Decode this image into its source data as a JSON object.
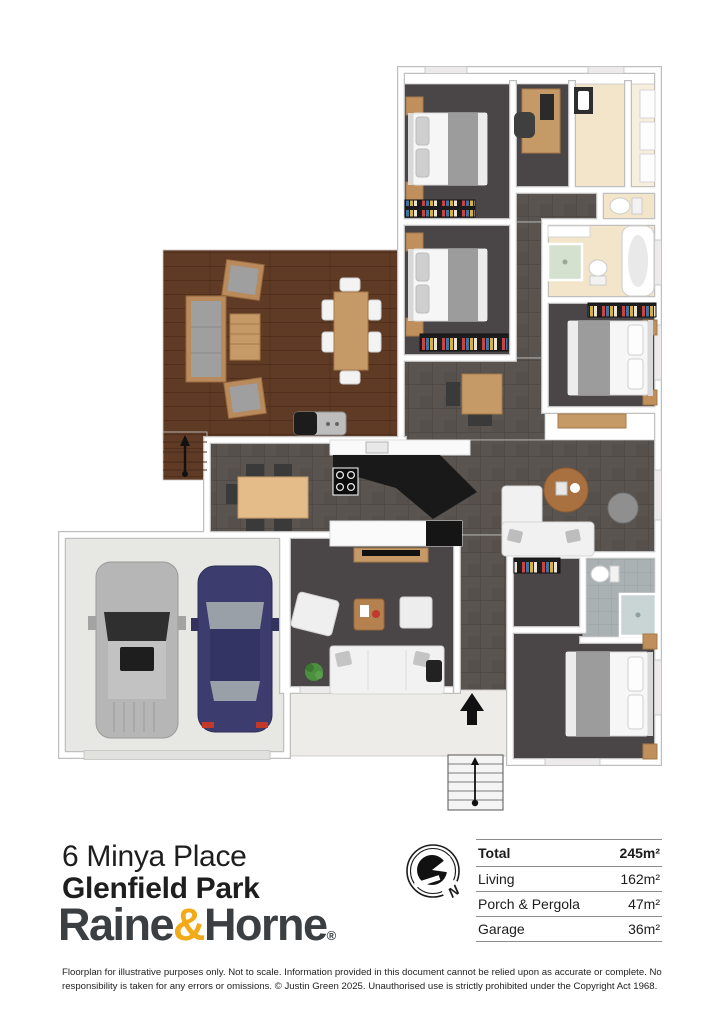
{
  "property": {
    "address_line1": "6 Minya Place",
    "address_line2": "Glenfield Park"
  },
  "brand": {
    "name_left": "Raine",
    "ampersand": "&",
    "name_right": "Horne",
    "registered": "®"
  },
  "compass": {
    "label": "N"
  },
  "areas_table": {
    "rows": [
      {
        "label": "Total",
        "value": "245m²"
      },
      {
        "label": "Living",
        "value": "162m²"
      },
      {
        "label": "Porch & Pergola",
        "value": "47m²"
      },
      {
        "label": "Garage",
        "value": "36m²"
      }
    ]
  },
  "disclaimer": "Floorplan for illustrative purposes only. Not to scale. Information provided in this document cannot be relied upon as accurate or complete. No responsibility is taken for any errors or omissions. © Justin Green 2025. Unauthorised use is strictly prohibited under the Copyright Act 1968.",
  "floorplan": {
    "colors": {
      "floor_dark": "#4a4546",
      "floor_tile": "#59544f",
      "floor_deck": "#5f3b26",
      "floor_cream": "#f2e5c9",
      "floor_garage": "#e7e7e4",
      "floor_porch": "#edece8",
      "floor_ensuite": "#aab1b3",
      "wall": "#ffffff",
      "accent_gold": "#f2ab18",
      "logo_text": "#3b3f42"
    }
  }
}
